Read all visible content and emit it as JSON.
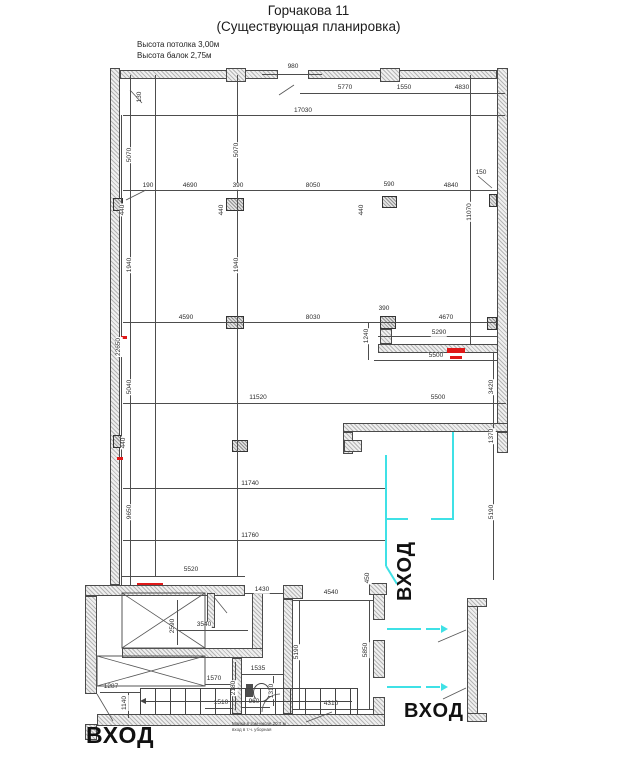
{
  "title": {
    "line1": "Горчакова 11",
    "line2": "(Существующая планировка)"
  },
  "notes": {
    "ceiling": "Высота потолка 3,00м",
    "beams": "Высота балок 2,75м"
  },
  "entrances": {
    "bottom_left": "ВХОД",
    "bottom_right": "ВХОД",
    "side_rotated": "ВХОД"
  },
  "annotation_note": {
    "line1": "Мойка в том числе 20,7 м",
    "line2": "вход в т.ч. уборная"
  },
  "colors": {
    "wall_hatch": "#b5b5b5",
    "line": "#4d4d4d",
    "cyan": "#3fe1e6",
    "red": "#e01818",
    "text": "#2c2c2c"
  },
  "plan": {
    "walls": [
      [
        110,
        68,
        10,
        517
      ],
      [
        85,
        596,
        12,
        98
      ],
      [
        85,
        724,
        12,
        16
      ],
      [
        120,
        70,
        158,
        9
      ],
      [
        308,
        70,
        189,
        9
      ],
      [
        497,
        68,
        11,
        385
      ],
      [
        226,
        68,
        20,
        14
      ],
      [
        380,
        68,
        20,
        14
      ],
      [
        378,
        344,
        120,
        9
      ],
      [
        380,
        329,
        12,
        15
      ],
      [
        343,
        423,
        165,
        9
      ],
      [
        343,
        432,
        10,
        22
      ],
      [
        344,
        440,
        18,
        12
      ],
      [
        497,
        432,
        11,
        21
      ],
      [
        85,
        585,
        160,
        11
      ],
      [
        283,
        585,
        20,
        14
      ],
      [
        283,
        599,
        10,
        115
      ],
      [
        373,
        585,
        12,
        35
      ],
      [
        373,
        640,
        12,
        38
      ],
      [
        373,
        697,
        12,
        27
      ],
      [
        369,
        583,
        18,
        12
      ],
      [
        97,
        714,
        288,
        12
      ],
      [
        207,
        593,
        8,
        35
      ],
      [
        252,
        593,
        11,
        57
      ],
      [
        122,
        648,
        141,
        10
      ],
      [
        232,
        658,
        10,
        56
      ],
      [
        467,
        598,
        11,
        124
      ],
      [
        467,
        598,
        20,
        9
      ],
      [
        467,
        713,
        20,
        9
      ]
    ],
    "columns": [
      [
        113,
        198,
        10,
        13
      ],
      [
        226,
        198,
        18,
        13
      ],
      [
        382,
        196,
        15,
        12
      ],
      [
        489,
        194,
        8,
        13
      ],
      [
        226,
        316,
        18,
        13
      ],
      [
        380,
        316,
        16,
        13
      ],
      [
        487,
        317,
        10,
        13
      ],
      [
        232,
        440,
        16,
        12
      ],
      [
        113,
        435,
        8,
        13
      ]
    ],
    "lines": [
      [
        300,
        93,
        205,
        1
      ],
      [
        123,
        115,
        382,
        1
      ],
      [
        262,
        74,
        60,
        1
      ],
      [
        123,
        190,
        374,
        1
      ],
      [
        123,
        322,
        374,
        1
      ],
      [
        378,
        336,
        119,
        1
      ],
      [
        374,
        360,
        123,
        1
      ],
      [
        123,
        403,
        383,
        1
      ],
      [
        123,
        488,
        264,
        1
      ],
      [
        123,
        540,
        264,
        1
      ],
      [
        121,
        576,
        124,
        1
      ],
      [
        245,
        593,
        38,
        1
      ],
      [
        293,
        600,
        80,
        1
      ],
      [
        293,
        709,
        80,
        1
      ],
      [
        130,
        75,
        1,
        510
      ],
      [
        121,
        115,
        1,
        470
      ],
      [
        237,
        75,
        1,
        501
      ],
      [
        470,
        75,
        1,
        270
      ],
      [
        493,
        352,
        1,
        228
      ],
      [
        368,
        322,
        1,
        38
      ],
      [
        299,
        600,
        1,
        109
      ],
      [
        369,
        600,
        1,
        109
      ],
      [
        177,
        600,
        1,
        45
      ],
      [
        172,
        630,
        76,
        1
      ],
      [
        205,
        684,
        27,
        1
      ],
      [
        205,
        708,
        27,
        1
      ],
      [
        242,
        674,
        41,
        1
      ],
      [
        242,
        707,
        28,
        1
      ],
      [
        100,
        692,
        40,
        1
      ],
      [
        128,
        692,
        1,
        26
      ],
      [
        235,
        662,
        1,
        48
      ],
      [
        273,
        676,
        1,
        30
      ],
      [
        155,
        75,
        1,
        501
      ]
    ],
    "labels": [
      {
        "t": "980",
        "x": 293,
        "y": 67,
        "r": 0
      },
      {
        "t": "5770",
        "x": 345,
        "y": 88,
        "r": 0
      },
      {
        "t": "1550",
        "x": 404,
        "y": 88,
        "r": 0
      },
      {
        "t": "4830",
        "x": 462,
        "y": 88,
        "r": 0
      },
      {
        "t": "17030",
        "x": 303,
        "y": 111,
        "r": 0
      },
      {
        "t": "130",
        "x": 140,
        "y": 97,
        "r": 1
      },
      {
        "t": "5070",
        "x": 130,
        "y": 155,
        "r": 1
      },
      {
        "t": "5070",
        "x": 237,
        "y": 150,
        "r": 1
      },
      {
        "t": "190",
        "x": 148,
        "y": 186,
        "r": 0
      },
      {
        "t": "4690",
        "x": 190,
        "y": 186,
        "r": 0
      },
      {
        "t": "390",
        "x": 238,
        "y": 186,
        "r": 0
      },
      {
        "t": "8050",
        "x": 313,
        "y": 186,
        "r": 0
      },
      {
        "t": "590",
        "x": 389,
        "y": 185,
        "r": 0
      },
      {
        "t": "4840",
        "x": 451,
        "y": 186,
        "r": 0
      },
      {
        "t": "150",
        "x": 481,
        "y": 173,
        "r": 0
      },
      {
        "t": "440",
        "x": 123,
        "y": 210,
        "r": 1
      },
      {
        "t": "440",
        "x": 222,
        "y": 210,
        "r": 1
      },
      {
        "t": "440",
        "x": 362,
        "y": 210,
        "r": 1
      },
      {
        "t": "11070",
        "x": 470,
        "y": 212,
        "r": 1
      },
      {
        "t": "1940",
        "x": 130,
        "y": 265,
        "r": 1
      },
      {
        "t": "1940",
        "x": 237,
        "y": 265,
        "r": 1
      },
      {
        "t": "4590",
        "x": 186,
        "y": 318,
        "r": 0
      },
      {
        "t": "8030",
        "x": 313,
        "y": 318,
        "r": 0
      },
      {
        "t": "390",
        "x": 384,
        "y": 309,
        "r": 0
      },
      {
        "t": "4670",
        "x": 446,
        "y": 318,
        "r": 0
      },
      {
        "t": "1240",
        "x": 367,
        "y": 336,
        "r": 1
      },
      {
        "t": "5290",
        "x": 439,
        "y": 333,
        "r": 0
      },
      {
        "t": "5500",
        "x": 436,
        "y": 356,
        "r": 0
      },
      {
        "t": "3420",
        "x": 492,
        "y": 387,
        "r": 1
      },
      {
        "t": "22650",
        "x": 119,
        "y": 347,
        "r": 1
      },
      {
        "t": "5040",
        "x": 130,
        "y": 387,
        "r": 1
      },
      {
        "t": "11520",
        "x": 258,
        "y": 398,
        "r": 0
      },
      {
        "t": "5500",
        "x": 438,
        "y": 398,
        "r": 0
      },
      {
        "t": "440",
        "x": 124,
        "y": 443,
        "r": 1
      },
      {
        "t": "1370",
        "x": 492,
        "y": 436,
        "r": 1
      },
      {
        "t": "11740",
        "x": 250,
        "y": 484,
        "r": 0
      },
      {
        "t": "9650",
        "x": 130,
        "y": 512,
        "r": 1
      },
      {
        "t": "5190",
        "x": 492,
        "y": 512,
        "r": 1
      },
      {
        "t": "11760",
        "x": 250,
        "y": 536,
        "r": 0
      },
      {
        "t": "5520",
        "x": 191,
        "y": 570,
        "r": 0
      },
      {
        "t": "1430",
        "x": 262,
        "y": 590,
        "r": 0
      },
      {
        "t": "450",
        "x": 368,
        "y": 578,
        "r": 1
      },
      {
        "t": "4540",
        "x": 331,
        "y": 593,
        "r": 0
      },
      {
        "t": "2590",
        "x": 173,
        "y": 626,
        "r": 1
      },
      {
        "t": "3540",
        "x": 204,
        "y": 625,
        "r": 0
      },
      {
        "t": "1570",
        "x": 214,
        "y": 679,
        "r": 0
      },
      {
        "t": "1535",
        "x": 258,
        "y": 669,
        "r": 0
      },
      {
        "t": "1287",
        "x": 111,
        "y": 687,
        "r": 0
      },
      {
        "t": "1140",
        "x": 125,
        "y": 703,
        "r": 1
      },
      {
        "t": "1510",
        "x": 221,
        "y": 703,
        "r": 0
      },
      {
        "t": "960",
        "x": 254,
        "y": 702,
        "r": 0
      },
      {
        "t": "2180",
        "x": 234,
        "y": 688,
        "r": 1
      },
      {
        "t": "1310",
        "x": 272,
        "y": 691,
        "r": 1
      },
      {
        "t": "4310",
        "x": 331,
        "y": 704,
        "r": 0
      },
      {
        "t": "5190",
        "x": 297,
        "y": 652,
        "r": 1
      },
      {
        "t": "5850",
        "x": 366,
        "y": 650,
        "r": 1
      }
    ],
    "cyan": [
      [
        452,
        432,
        2,
        88
      ],
      [
        385,
        455,
        2,
        65
      ],
      [
        385,
        518,
        23,
        2
      ],
      [
        431,
        518,
        23,
        2
      ],
      [
        385,
        520,
        2,
        46
      ],
      [
        387,
        628,
        34,
        2
      ],
      [
        426,
        628,
        14,
        2
      ],
      [
        387,
        686,
        34,
        2
      ],
      [
        426,
        686,
        14,
        2
      ]
    ],
    "cyan_arrows": [
      [
        441,
        625
      ],
      [
        441,
        683
      ]
    ],
    "cyan_diag": [
      [
        386,
        566,
        397,
        584
      ]
    ],
    "red": [
      [
        121,
        336,
        6,
        3
      ],
      [
        117,
        457,
        6,
        3
      ],
      [
        137,
        583,
        26,
        2
      ],
      [
        447,
        348,
        18,
        5
      ],
      [
        450,
        356,
        12,
        3
      ]
    ],
    "crosses": [
      [
        122,
        593,
        83,
        55
      ],
      [
        97,
        656,
        108,
        30
      ]
    ],
    "leaders": [
      [
        438,
        642,
        466,
        630
      ],
      [
        443,
        699,
        466,
        688
      ],
      [
        306,
        722,
        332,
        712
      ],
      [
        97,
        694,
        113,
        721
      ],
      [
        214,
        597,
        227,
        613
      ],
      [
        478,
        176,
        492,
        188
      ],
      [
        142,
        103,
        130,
        90
      ],
      [
        146,
        190,
        126,
        200
      ],
      [
        279,
        95,
        294,
        85
      ]
    ],
    "arcs": [
      {
        "d": "M262,712 A18,18 0 0 1 280,694"
      }
    ],
    "wc": {
      "tank": [
        246,
        684,
        7,
        13
      ],
      "bowl": [
        253,
        683,
        15,
        17
      ]
    }
  }
}
